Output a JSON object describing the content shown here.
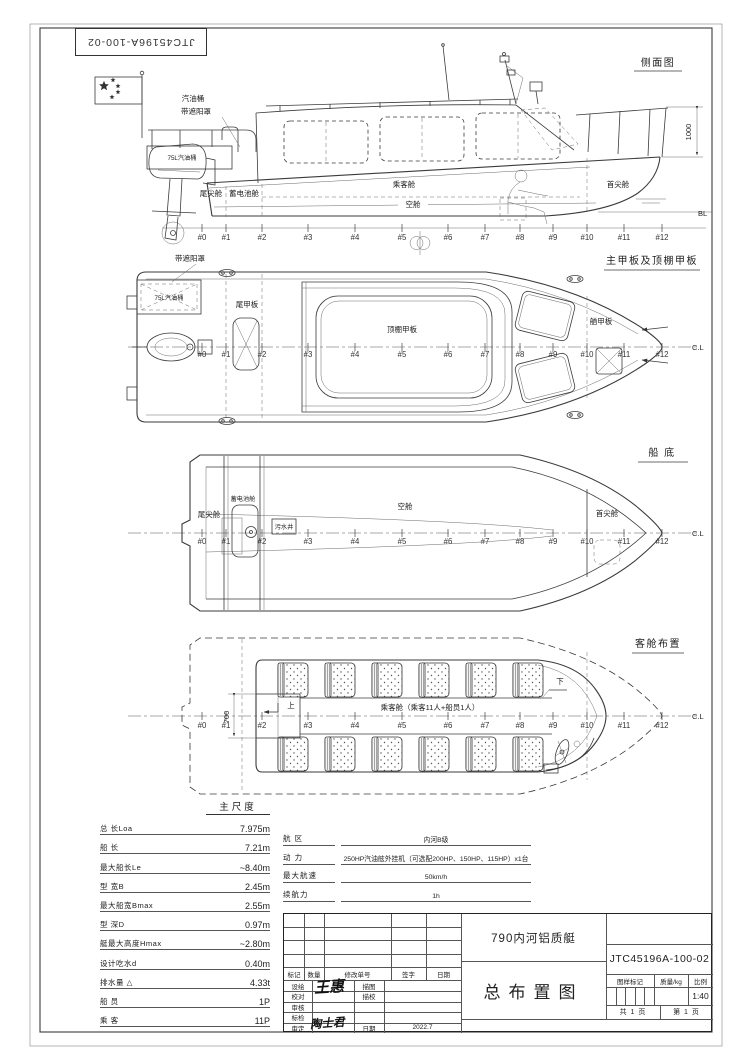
{
  "doc_number_top": "JTC45196A-100-02",
  "stations": [
    "#0",
    "#1",
    "#2",
    "#3",
    "#4",
    "#5",
    "#6",
    "#7",
    "#8",
    "#9",
    "#10",
    "#11",
    "#12"
  ],
  "centerline_label": "C.L",
  "views": {
    "side": {
      "title": "侧面图",
      "labels": {
        "fuel_tank_callout": "汽油桶",
        "sunshade_callout": "带遮阳罩",
        "fuel_tank_75l": "75L汽油桶",
        "aft_peak": "尾尖舱",
        "battery_compartment": "蓄电池舱",
        "passenger_cabin": "乘客舱",
        "void_space": "空舱",
        "fore_peak": "首尖舱",
        "height_dim": "1000",
        "baseline": "BL"
      }
    },
    "deck": {
      "title": "主甲板及顶棚甲板",
      "labels": {
        "sunshade_callout": "带遮阳罩",
        "fuel_tank_75l": "75L汽油桶",
        "aft_deck": "尾甲板",
        "roof_deck": "顶棚甲板",
        "fore_deck": "艏甲板"
      }
    },
    "bottom": {
      "title": "船 底",
      "labels": {
        "aft_peak": "尾尖舱",
        "battery_compartment": "蓄电池舱",
        "bilge_well": "污水井",
        "void_space": "空舱",
        "fore_peak": "首尖舱"
      }
    },
    "cabin": {
      "title": "客舱布置",
      "labels": {
        "passenger_note": "乘客舱（乘客11人+船员1人）",
        "width_dim": "700",
        "up": "上",
        "down": "下"
      }
    }
  },
  "principal_dimensions": {
    "title": "主尺度",
    "rows": [
      {
        "label": "总  长Loa",
        "value": "7.975m"
      },
      {
        "label": "船  长",
        "value": "7.21m"
      },
      {
        "label": "最大船长Le",
        "value": "~8.40m"
      },
      {
        "label": "型  宽B",
        "value": "2.45m"
      },
      {
        "label": "最大船宽Bmax",
        "value": "2.55m"
      },
      {
        "label": "型  深D",
        "value": "0.97m"
      },
      {
        "label": "艇最大高度Hmax",
        "value": "~2.80m"
      },
      {
        "label": "设计吃水d",
        "value": "0.40m"
      },
      {
        "label": "排水量 △",
        "value": "4.33t"
      },
      {
        "label": "船  员",
        "value": "1P"
      },
      {
        "label": "乘  客",
        "value": "11P"
      }
    ]
  },
  "specs": {
    "rows": [
      {
        "label": "航  区",
        "value": "内河B级"
      },
      {
        "label": "动  力",
        "value": "250HP汽油舷外挂机（可选配200HP、150HP、115HP）x1台"
      },
      {
        "label": "最大航速",
        "value": "50km/h"
      },
      {
        "label": "续航力",
        "value": "1h"
      }
    ]
  },
  "title_block": {
    "product_name": "790内河铝质艇",
    "drawing_title": "总布置图",
    "drawing_number": "JTC45196A-100-02",
    "revision_header": [
      "标记",
      "数量",
      "修改单号",
      "签字",
      "日期"
    ],
    "role_labels": [
      "设绘",
      "校对",
      "审核",
      "标检",
      "审定"
    ],
    "trace_labels": [
      "描图",
      "描校"
    ],
    "date_label": "日期",
    "date_value": "2022.7",
    "stamp_label": "图样标记",
    "mass_label": "质量/kg",
    "scale_label": "比例",
    "scale_value": "1:40",
    "pages_total": "共 1 页",
    "page_number": "第 1 页",
    "signatures": [
      "王惠",
      "陶士君"
    ]
  }
}
